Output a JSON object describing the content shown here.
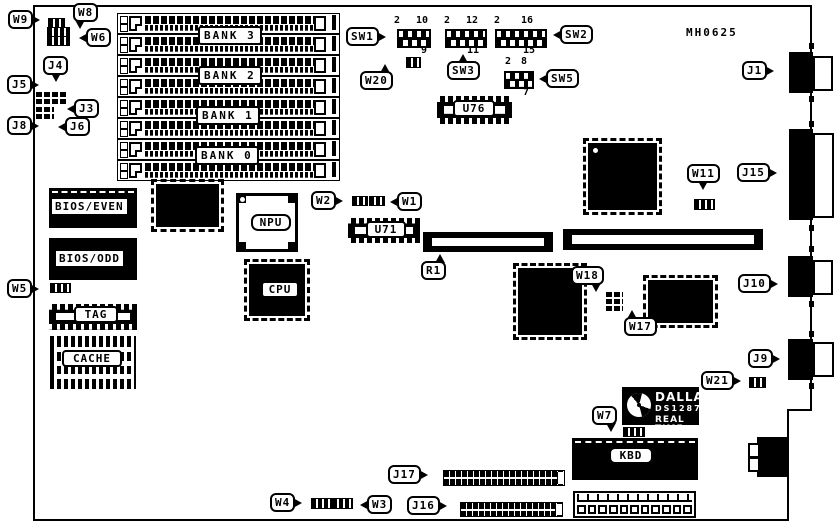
{
  "board_id": "MH0625",
  "banks": [
    "BANK 3",
    "BANK 2",
    "BANK 1",
    "BANK 0"
  ],
  "chips": {
    "bios_even": "BIOS/EVEN",
    "bios_odd": "BIOS/ODD",
    "npu": "NPU",
    "cpu": "CPU",
    "tag": "TAG",
    "cache": "CACHE",
    "u76": "U76",
    "u71": "U71",
    "kbd": "KBD"
  },
  "rtc": {
    "brand": "DALLAS",
    "model": "DS1287",
    "type": "REAL TIME"
  },
  "callouts": {
    "w9": "W9",
    "w8": "W8",
    "w6": "W6",
    "j4": "J4",
    "j5": "J5",
    "j3": "J3",
    "j8": "J8",
    "j6": "J6",
    "sw1": "SW1",
    "sw2": "SW2",
    "sw3": "SW3",
    "sw5": "SW5",
    "w20": "W20",
    "j1": "J1",
    "w2": "W2",
    "w1": "W1",
    "r1": "R1",
    "w5": "W5",
    "w11": "W11",
    "j15": "J15",
    "j10": "J10",
    "w18": "W18",
    "w17": "W17",
    "j9": "J9",
    "w21": "W21",
    "w7": "W7",
    "j17": "J17",
    "j16": "J16",
    "w4": "W4",
    "w3": "W3"
  },
  "switch_pins": {
    "sw1": {
      "first": "2",
      "last_top": "10",
      "last_bottom": "9"
    },
    "sw3": {
      "first": "2",
      "last_top": "12",
      "last_bottom": "11"
    },
    "sw2": {
      "first": "2",
      "last_top": "16",
      "last_bottom": "15"
    },
    "sw5": {
      "first": "2",
      "last_top": "8",
      "last_bottom": "7"
    }
  },
  "colors": {
    "ink": "#000000",
    "paper": "#ffffff"
  }
}
